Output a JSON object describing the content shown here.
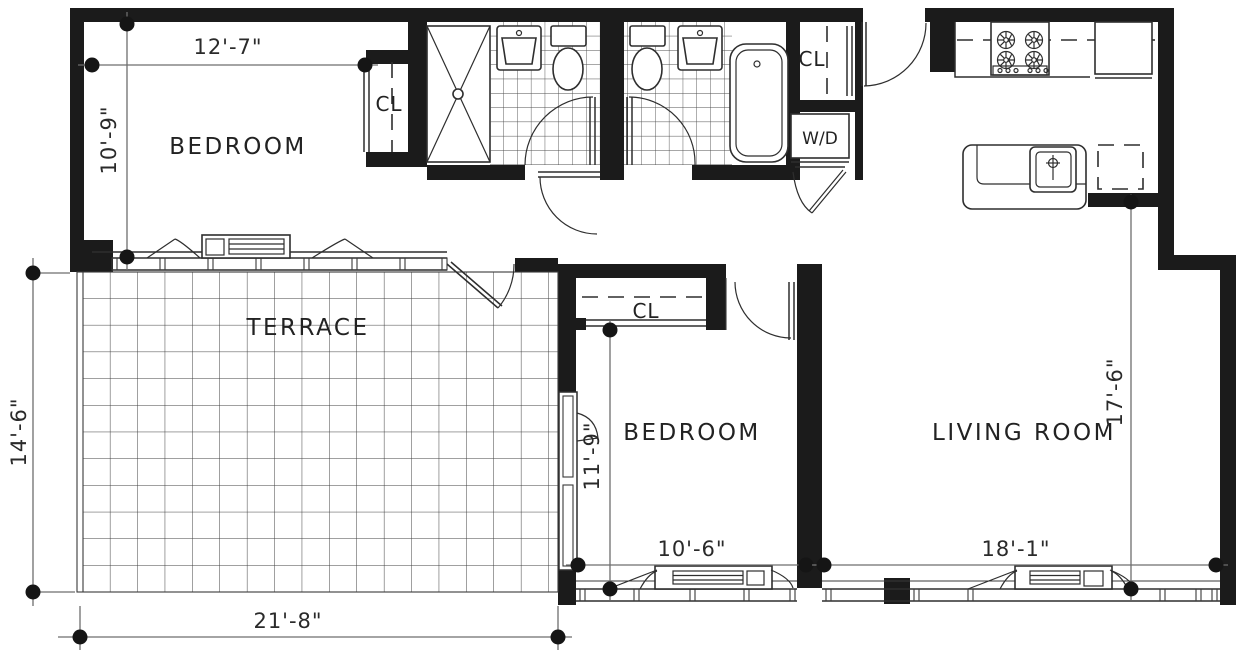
{
  "plan": {
    "type": "apartment-floor-plan",
    "rooms": {
      "bedroom_1": {
        "label": "BEDROOM",
        "width": "12'-7\"",
        "depth": "10'-9\""
      },
      "bedroom_2": {
        "label": "BEDROOM",
        "width": "10'-6\"",
        "depth": "11'-9\""
      },
      "living_room": {
        "label": "LIVING ROOM",
        "width": "18'-1\"",
        "depth": "17'-6\""
      },
      "terrace": {
        "label": "TERRACE",
        "width": "21'-8\"",
        "depth": "14'-6\""
      },
      "closet_bedroom_1": {
        "label": "CL"
      },
      "closet_bedroom_2": {
        "label": "CL"
      },
      "closet_entry": {
        "label": "CL"
      },
      "laundry": {
        "label": "W/D"
      }
    },
    "fixtures": [
      "shower",
      "bathroom-sink",
      "toilet",
      "toilet",
      "bathroom-sink",
      "bathtub",
      "washer-dryer",
      "range-stove",
      "refrigerator",
      "kitchen-island-sink",
      "dishwasher",
      "hvac-convector",
      "hvac-convector",
      "hvac-convector"
    ],
    "colors": {
      "background": "#ffffff",
      "walls": "#1b1b1b",
      "linework": "#2e2e2e",
      "dimension_lines": "#6e6e6e",
      "tile_lines": "#4d4d4d"
    }
  }
}
